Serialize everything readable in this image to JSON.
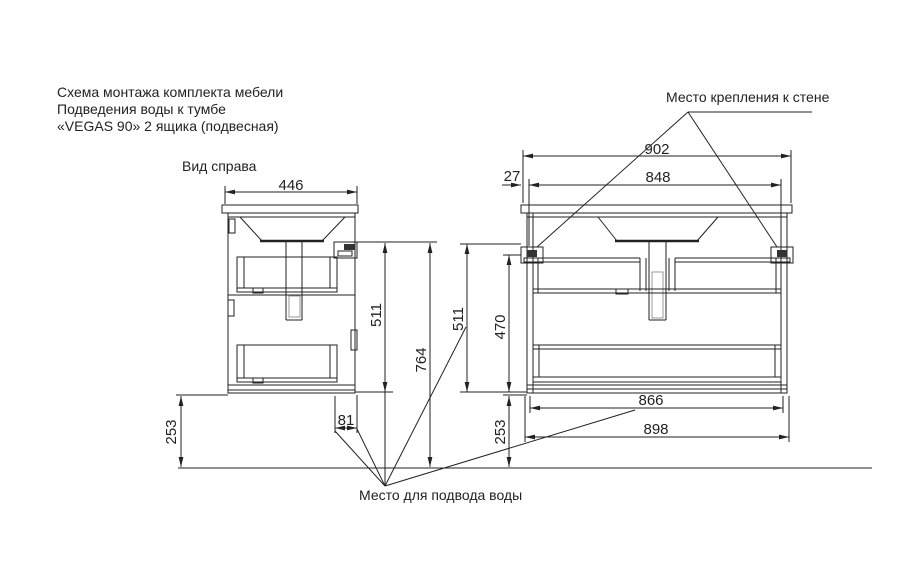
{
  "title": {
    "line1": "Схема монтажа комплекта мебели",
    "line2": "Подведения воды к тумбе",
    "line3": "«VEGAS 90» 2 ящика (подвесная)"
  },
  "labels": {
    "side_view": "Вид справа",
    "wall_mount": "Место крепления к стене",
    "water_supply": "Место для подвода воды"
  },
  "dimensions": {
    "side_depth": "446",
    "side_height": "511",
    "total_height": "764",
    "floor_gap_left": "253",
    "water_offset": "81",
    "front_total_width": "902",
    "bracket_edge_offset": "27",
    "bracket_span": "848",
    "front_height": "511",
    "carcass_height": "470",
    "floor_gap_right": "253",
    "inner_width": "866",
    "outer_width": "898"
  },
  "colors": {
    "background": "#ffffff",
    "line": "#222222"
  }
}
